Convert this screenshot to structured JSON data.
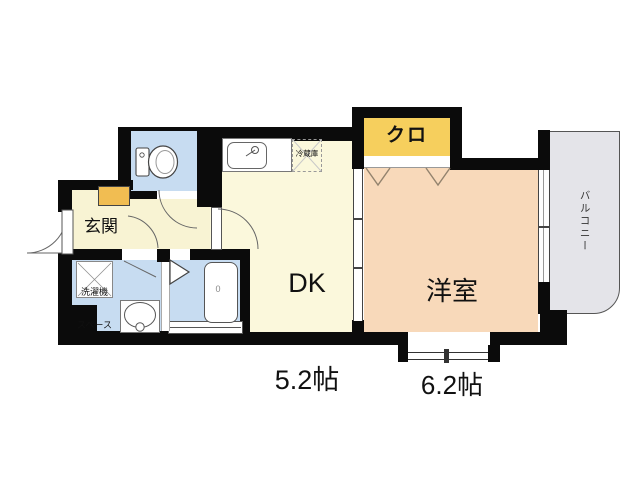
{
  "floorplan": {
    "rooms": {
      "entrance": {
        "name": "玄関"
      },
      "dining_kitchen": {
        "line1": "DK",
        "line2": "5.2帖"
      },
      "western_room": {
        "line1": "洋室",
        "line2": "6.2帖"
      },
      "closet": {
        "name": "クロ"
      },
      "balcony": {
        "name": "バルコニー"
      }
    },
    "fixtures": {
      "laundry_space": {
        "line1": "洗濯機",
        "line2": "スペース"
      },
      "refrigerator": {
        "name": "冷蔵庫"
      },
      "bathtub": {
        "mark": "0"
      }
    },
    "icons": {
      "toilet": "toilet-icon",
      "kitchen_sink": "kitchen-sink-icon",
      "washbasin": "washbasin-icon",
      "bathtub": "bathtub-icon",
      "door_swing": "door-swing-arc-icon",
      "folding_door": "folding-door-icon",
      "sliding_door": "sliding-door-icon",
      "window": "window-icon"
    },
    "colors": {
      "wall": "#0b0b0b",
      "entrance_hall": "#f8f3d3",
      "dining_kitchen": "#fbf8dc",
      "western_room": "#f8d9ba",
      "closet": "#f6cf5d",
      "shoe_cabinet": "#f1bd52",
      "wet_area": "#c7dcf1",
      "balcony": "#e4e4e9"
    }
  }
}
